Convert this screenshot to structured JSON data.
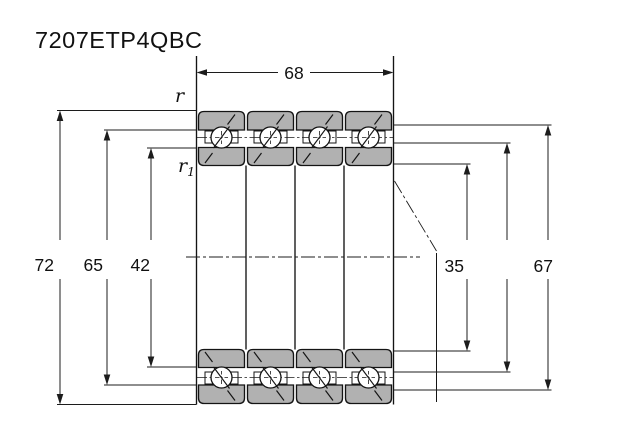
{
  "drawing": {
    "part_number": "7207ETP4QBC",
    "width_dimension": "68",
    "left_dimensions": [
      "72",
      "65",
      "42"
    ],
    "right_dimensions": [
      "35",
      "67"
    ],
    "fillet_labels": {
      "outer": "r",
      "inner_base": "r",
      "inner_subscript": "1"
    },
    "colors": {
      "ring_fill": "#b1b1b1",
      "line": "#1c1c1c",
      "background": "#ffffff"
    }
  }
}
